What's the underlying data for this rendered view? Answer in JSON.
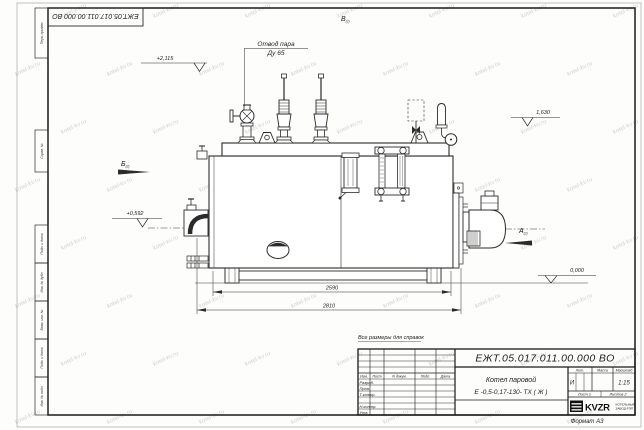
{
  "sheet": {
    "watermark": "kotel-kv.ru",
    "format_note": "Формат А3",
    "reference_note": "Все размеры для справок"
  },
  "frame_stamps": {
    "top_designation": "ЕЖТ.05.017.011.00.000  ВО",
    "left_labels": [
      "Перв. примен.",
      "Справ. №",
      "Подп. и дата",
      "Инв. № дубл.",
      "Взам. инв. №",
      "Подп. и дата",
      "Инв. № подл."
    ]
  },
  "drawing": {
    "callout_steam_outlet": {
      "line1": "Отвод пара",
      "line2": "Ду 65"
    },
    "view_labels": {
      "top": "В",
      "left": "Б",
      "right": "А",
      "sheet_ref": "(2)"
    },
    "elevation_marks": {
      "top": "+2,115",
      "right_upper": "1,630",
      "left": "+0,592",
      "ground": "0,000"
    },
    "dimensions": {
      "skid_length": "2590",
      "overall_length": "2810"
    }
  },
  "title_block": {
    "designation": "ЕЖТ.05.017.011.00.000  ВО",
    "product_name_line1": "Котел паровой",
    "product_name_line2": "Е -0,5-0,17-130- ТХ ( Ж )",
    "columns": [
      "Изм.",
      "Лист",
      "N докум.",
      "Подп.",
      "Дата"
    ],
    "rows": [
      "Разраб.",
      "Пров.",
      "Т.контр.",
      "Н.контр.",
      "Утв."
    ],
    "spec_headers": [
      "Лит.",
      "Масса",
      "Масштаб"
    ],
    "liter_value": "И",
    "scale_value": "1:15",
    "sheet_info": {
      "sheet": "Лист 1",
      "sheets": "Листов 2"
    },
    "company": {
      "logo": "KVZR",
      "name_line1": "КОТЕЛЬНЫЙ",
      "name_line2": "ЗАВОД РЭП"
    }
  }
}
